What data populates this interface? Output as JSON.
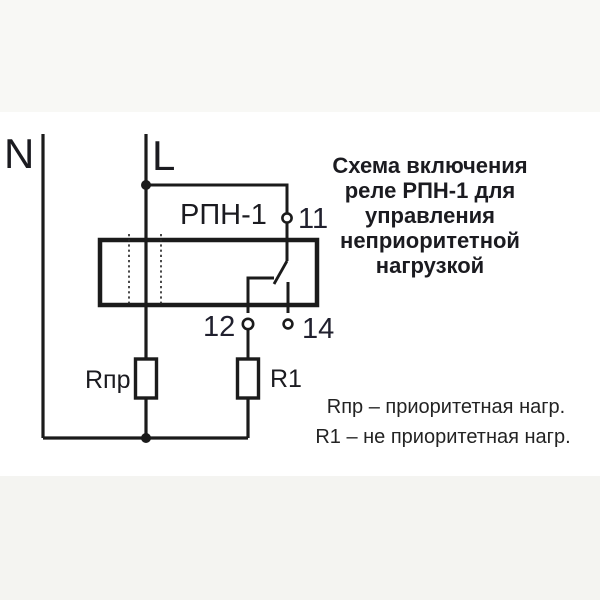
{
  "colors": {
    "ink": "#1b1b1b",
    "background": "#ffffff"
  },
  "feeds": {
    "neutral_label": "N",
    "line_label": "L"
  },
  "relay": {
    "name": "РПН-1",
    "terminal_11": "11",
    "terminal_12": "12",
    "terminal_14": "14"
  },
  "loads": {
    "priority_label": "Rпр",
    "non_priority_label": "R1"
  },
  "title": {
    "lines": [
      "Схема включения",
      "реле РПН-1 для",
      "управления",
      "неприоритетной",
      "нагрузкой"
    ]
  },
  "legend": {
    "lines": [
      "Rпр – приоритетная нагр.",
      "R1 – не приоритетная нагр."
    ]
  }
}
